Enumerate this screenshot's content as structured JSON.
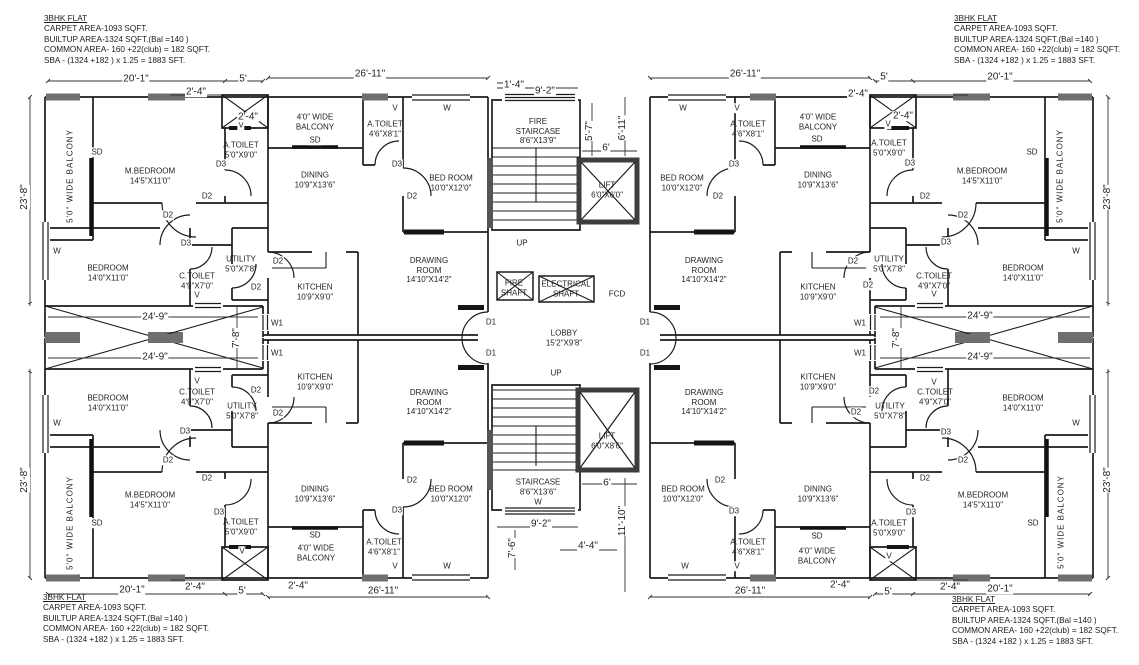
{
  "info": {
    "title": "3BHK FLAT",
    "l1": "CARPET AREA-1093 SQFT.",
    "l2": "BUILTUP AREA-1324 SQFT.(Bal =140 )",
    "l3": "COMMON AREA- 160 +22(club) = 182 SQFT.",
    "l4": "SBA - (1324 +182 ) x 1.25 = 1883 SFT."
  },
  "rooms": {
    "m_bedroom": {
      "name": "M.BEDROOM",
      "size": "14'5\"X11'0\""
    },
    "bedroom": {
      "name": "BEDROOM",
      "size": "14'0\"X11'0\""
    },
    "bed_room": {
      "name": "BED ROOM",
      "size": "10'0\"X12'0\""
    },
    "dining": {
      "name": "DINING",
      "size": "10'9\"X13'6\""
    },
    "kitchen": {
      "name": "KITCHEN",
      "size": "10'9\"X9'0\""
    },
    "drawing_room": {
      "l1": "DRAWING",
      "l2": "ROOM",
      "size": "14'10\"X14'2\""
    },
    "utility": {
      "name": "UTILITY",
      "size": "5'0\"X7'8\""
    },
    "c_toilet": {
      "name": "C.TOILET",
      "size": "4'9\"X7'0\""
    },
    "a_toilet_big": {
      "name": "A.TOILET",
      "size": "5'0\"X9'0\""
    },
    "a_toilet_small": {
      "name": "A.TOILET",
      "size": "4'6\"X8'1\""
    },
    "side_balcony": {
      "name": "5'0\" WIDE BALCONY"
    },
    "front_balcony": {
      "l1": "4'0\" WIDE",
      "l2": "BALCONY"
    }
  },
  "core": {
    "fire_staircase": {
      "l1": "FIRE",
      "l2": "STAIRCASE",
      "size": "8'6\"X13'9\""
    },
    "staircase": {
      "name": "STAIRCASE",
      "size": "8'6\"X13'6\""
    },
    "lift_top": {
      "name": "LIFT",
      "size": "6'0\"X6'0\""
    },
    "lift_bottom": {
      "name": "LIFT",
      "size": "6'0\"X8'6\""
    },
    "lobby": {
      "name": "LOBBY",
      "size": "15'2\"X9'8\""
    },
    "fire_shaft": {
      "l1": "FIRE",
      "l2": "SHAFT"
    },
    "electrical_shaft": {
      "l1": "ELECTRICAL",
      "l2": "SHAFT"
    },
    "fcd": "FCD",
    "up": "UP"
  },
  "markers": {
    "sd": "SD",
    "w": "W",
    "w1": "W1",
    "v": "V",
    "d1": "D1",
    "d2": "D2",
    "d3": "D3"
  },
  "dims": {
    "d20_1": "20'-1\"",
    "d5": "5'",
    "d2_4": "2'-4\"",
    "d26_11": "26'-11\"",
    "d1_4": "1'-4\"",
    "d9_2": "9'-2\"",
    "d5_7": "5'-7\"",
    "d6_11": "6'-11\"",
    "d6": "6'",
    "d23_8": "23'-8\"",
    "d24_9": "24'-9\"",
    "d7_8": "7'-8\"",
    "d7_6": "7'-6\"",
    "d4_4": "4'-4\"",
    "d11_10": "11'-10\""
  }
}
